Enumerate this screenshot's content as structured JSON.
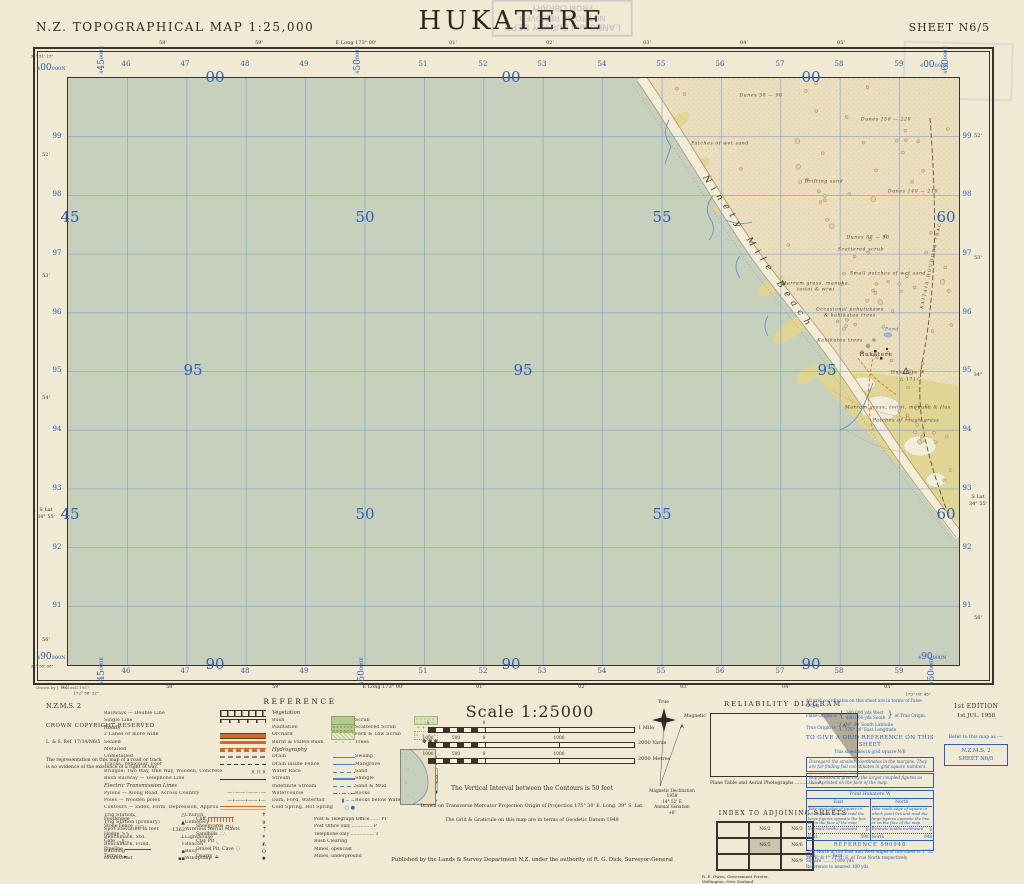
{
  "header": {
    "left": "N.Z. TOPOGRAPHICAL MAP  1:25,000",
    "title": "HUKATERE",
    "right": "SHEET N6/5"
  },
  "stamp": {
    "line1": "LANDS and SURVEY DEPT.",
    "line2": "NOT TO BE REMOVED",
    "line3": "FROM LIBRARY"
  },
  "colors": {
    "paper": "#f0e9d3",
    "sea": "#c6d0bd",
    "sand": "#ecdfc0",
    "beach": "#f3ecd8",
    "grass": "#e0d592",
    "grid_blue": "#7fa3cf",
    "number_blue": "#2d5eb0",
    "road_orange": "#cf6b2e",
    "stream_blue": "#5f8dc4",
    "border_ink": "#39332a"
  },
  "map": {
    "drawn_note": "Drawn by J. Maxwell 1957",
    "beach_name": "Ninety Mile Beach",
    "track_name": "KAITAIA  HOUHORA  TRACK",
    "grid": {
      "eastings": [
        {
          "x": 124,
          "t": "46"
        },
        {
          "x": 183,
          "t": "47"
        },
        {
          "x": 243,
          "t": "48"
        },
        {
          "x": 302,
          "t": "49"
        },
        {
          "x": 421,
          "t": "51"
        },
        {
          "x": 481,
          "t": "52"
        },
        {
          "x": 540,
          "t": "53"
        },
        {
          "x": 600,
          "t": "54"
        },
        {
          "x": 659,
          "t": "55"
        },
        {
          "x": 718,
          "t": "56"
        },
        {
          "x": 778,
          "t": "57"
        },
        {
          "x": 837,
          "t": "58"
        },
        {
          "x": 897,
          "t": "59"
        }
      ],
      "northings": [
        {
          "y": 134,
          "t": "99"
        },
        {
          "y": 192,
          "t": "98"
        },
        {
          "y": 251,
          "t": "97"
        },
        {
          "y": 310,
          "t": "96"
        },
        {
          "y": 368,
          "t": "95"
        },
        {
          "y": 427,
          "t": "94"
        },
        {
          "y": 486,
          "t": "93"
        },
        {
          "y": 545,
          "t": "92"
        },
        {
          "y": 603,
          "t": "91"
        }
      ],
      "big": [
        {
          "x": 147,
          "y": 0,
          "t": "00"
        },
        {
          "x": 443,
          "y": 0,
          "t": "00"
        },
        {
          "x": 743,
          "y": 0,
          "t": "00"
        },
        {
          "x": 2,
          "y": 140,
          "t": "45"
        },
        {
          "x": 297,
          "y": 140,
          "t": "50"
        },
        {
          "x": 594,
          "y": 140,
          "t": "55"
        },
        {
          "x": 878,
          "y": 140,
          "t": "60"
        },
        {
          "x": 125,
          "y": 293,
          "t": "95"
        },
        {
          "x": 455,
          "y": 293,
          "t": "95"
        },
        {
          "x": 759,
          "y": 293,
          "t": "95"
        },
        {
          "x": 2,
          "y": 437,
          "t": "45"
        },
        {
          "x": 297,
          "y": 437,
          "t": "50"
        },
        {
          "x": 594,
          "y": 437,
          "t": "55"
        },
        {
          "x": 878,
          "y": 437,
          "t": "60"
        },
        {
          "x": 147,
          "y": 587,
          "t": "90"
        },
        {
          "x": 443,
          "y": 587,
          "t": "90"
        },
        {
          "x": 743,
          "y": 587,
          "t": "90"
        }
      ],
      "corner_n": [
        {
          "x": 37,
          "y": 64,
          "a": "4",
          "b": "00",
          "c": "000N"
        },
        {
          "x": 920,
          "y": 61,
          "a": "4",
          "b": "00",
          "c": "000N"
        },
        {
          "x": 37,
          "y": 653,
          "a": "4",
          "b": "90",
          "c": "000N"
        },
        {
          "x": 918,
          "y": 653,
          "a": "4",
          "b": "90",
          "c": "000N"
        }
      ],
      "vertical_e": [
        {
          "x": 98,
          "y": 46,
          "a": "4",
          "b": "45",
          "c": "000E"
        },
        {
          "x": 98,
          "y": 657,
          "a": "4",
          "b": "45",
          "c": "000E"
        },
        {
          "x": 354,
          "y": 46,
          "a": "4",
          "b": "50",
          "c": "000E"
        },
        {
          "x": 358,
          "y": 657,
          "a": "4",
          "b": "50",
          "c": "000E"
        },
        {
          "x": 942,
          "y": 46,
          "a": "4",
          "b": "60",
          "c": "000E"
        },
        {
          "x": 928,
          "y": 657,
          "a": "4",
          "b": "60",
          "c": "000E"
        }
      ],
      "lats_left": [
        {
          "y": 155,
          "t": "52'"
        },
        {
          "y": 276,
          "t": "53'"
        },
        {
          "y": 398,
          "t": "54'"
        },
        {
          "y": 510,
          "t": "S Lat"
        },
        {
          "y": 517,
          "t": "34° 55'"
        },
        {
          "y": 640,
          "t": "56'"
        }
      ],
      "lats_right": [
        {
          "y": 136,
          "t": "52'"
        },
        {
          "y": 258,
          "t": "53'"
        },
        {
          "y": 375,
          "t": "34°"
        },
        {
          "y": 497,
          "t": "S Lat"
        },
        {
          "y": 504,
          "t": "34° 55'"
        },
        {
          "y": 618,
          "t": "56'"
        }
      ],
      "lons_top": [
        {
          "x": 163,
          "t": "58'"
        },
        {
          "x": 259,
          "t": "59'"
        },
        {
          "x": 356,
          "t": "E Long 173° 00'"
        },
        {
          "x": 453,
          "t": "01'"
        },
        {
          "x": 550,
          "t": "02'"
        },
        {
          "x": 647,
          "t": "03'"
        },
        {
          "x": 744,
          "t": "04'"
        },
        {
          "x": 841,
          "t": "05'"
        }
      ],
      "lons_bottom": [
        {
          "x": 65,
          "t": "57'"
        },
        {
          "x": 170,
          "t": "58'"
        },
        {
          "x": 276,
          "t": "59'"
        },
        {
          "x": 383,
          "t": "E Long 173° 00'"
        },
        {
          "x": 480,
          "t": "01'"
        },
        {
          "x": 582,
          "t": "02'"
        },
        {
          "x": 684,
          "t": "03'"
        },
        {
          "x": 786,
          "t": "04'"
        },
        {
          "x": 888,
          "t": "05'"
        }
      ],
      "corner_grat": [
        {
          "x": 42,
          "y": 56,
          "t": "34° 51' 15\""
        },
        {
          "x": 42,
          "y": 666,
          "t": "34° 56' 08\""
        },
        {
          "x": 86,
          "y": 693,
          "t": "172° 58' 32\""
        },
        {
          "x": 918,
          "y": 694,
          "t": "173° 05' 45\""
        }
      ]
    },
    "land_labels": [
      {
        "x": 693,
        "y": 18,
        "t": "Dunes   50 — 90",
        "c": "dune"
      },
      {
        "x": 818,
        "y": 42,
        "t": "Dunes   150 — 220",
        "c": "dune"
      },
      {
        "x": 652,
        "y": 66,
        "t": "Patches of wet sand",
        "c": "dune"
      },
      {
        "x": 756,
        "y": 104,
        "t": "Drifting      sand",
        "c": "dune"
      },
      {
        "x": 845,
        "y": 114,
        "t": "Dunes   140 — 210",
        "c": "dune"
      },
      {
        "x": 800,
        "y": 160,
        "t": "Dunes   80 — 90",
        "c": "dune"
      },
      {
        "x": 793,
        "y": 172,
        "t": "Scattered scrub",
        "c": "dune"
      },
      {
        "x": 820,
        "y": 196,
        "t": "Small patches of wet sand",
        "c": "dune"
      },
      {
        "x": 748,
        "y": 206,
        "t": "Marram grass, manuka,",
        "c": "dune"
      },
      {
        "x": 748,
        "y": 212,
        "t": "toitoi & wiwi",
        "c": "dune"
      },
      {
        "x": 782,
        "y": 232,
        "t": "Occasional pohutukawa",
        "c": "dune"
      },
      {
        "x": 782,
        "y": 238,
        "t": "& kahikatea trees",
        "c": "dune"
      },
      {
        "x": 772,
        "y": 263,
        "t": "Kahikatea trees",
        "c": "dune"
      },
      {
        "x": 824,
        "y": 252,
        "t": "Pond",
        "c": "blue"
      },
      {
        "x": 808,
        "y": 277,
        "t": "Hukatere",
        "c": "place"
      },
      {
        "x": 840,
        "y": 295,
        "t": "Hukatere W",
        "c": "trig"
      },
      {
        "x": 840,
        "y": 302,
        "t": "△ 171",
        "c": "trig"
      },
      {
        "x": 830,
        "y": 330,
        "t": "Marram grass, toitoi, manuka & flax",
        "c": "dune"
      },
      {
        "x": 838,
        "y": 343,
        "t": "Patches of rough grass",
        "c": "dune"
      }
    ]
  },
  "copyright": {
    "series": "N.Z.M.S. 2",
    "crown": "CROWN COPYRIGHT RESERVED",
    "ref": "L. & S. Ref. 17/34/N6/5",
    "para": "The representation on this map of a road or track is no evidence of the existence of a right of way."
  },
  "legend": {
    "title": "REFERENCE",
    "col1": [
      {
        "t": "Railways — Double Line",
        "s": "rail2"
      },
      {
        "t": "Single Line",
        "s": "rail1"
      },
      {
        "h": "Roads"
      },
      {
        "t": "2 Lanes or more wide",
        "s": "roadw"
      },
      {
        "t": "Sealed",
        "s": "roads"
      },
      {
        "t": "Metalled",
        "s": "roadm"
      },
      {
        "t": "Unmetalled",
        "s": "roadu"
      },
      {
        "t": "Tracks, Vehicular, Foot",
        "s": "trackd"
      },
      {
        "t": "Bridges: Two Way, One Way, Wooden, Concrete",
        "s": "g:)(  )(  )("
      },
      {
        "t": "Bush Railway — Telephone Line",
        "s": "tel"
      },
      {
        "h": "Electric Transmission Lines"
      },
      {
        "t": "Pylons — Along Road, Across Country",
        "s": "g:—◦——◦——◦—"
      },
      {
        "t": "Poles — Wooden poles",
        "s": "g:—•——•——•—"
      },
      {
        "t": "Contours — Index, Form, Depression, Approx.",
        "s": "cont"
      },
      {
        "a": [
          "Trig Station",
          "g:△"
        ],
        "b": [
          "Church",
          "g:✝"
        ]
      },
      {
        "a": [
          "Trig Station (primary)",
          "g:▲"
        ],
        "b": [
          "Cemetery",
          "g:✞"
        ]
      },
      {
        "a": [
          "Spot Elevation in feet",
          "g:· 1362"
        ],
        "b": [
          "Wireless Aerial Masts",
          "g:⍑"
        ]
      },
      {
        "a": [
          "Benchmark, Std.",
          "g:⊥"
        ],
        "b": [
          "Lighthouse",
          "g:✶"
        ]
      },
      {
        "a": [
          "Benchmark, Fund.",
          "g:⊦"
        ],
        "b": [
          "Beacon",
          "g:◭"
        ]
      },
      {
        "a": [
          "Building",
          "g:▪"
        ],
        "b": [
          "Buoy",
          "g:ʘ"
        ]
      },
      {
        "a": [
          "Homestead",
          "g:▪▪"
        ],
        "b": [
          "Windpump",
          "g:✹"
        ]
      }
    ],
    "col2": [
      {
        "h": "Vegetation"
      },
      {
        "a": [
          "Bush",
          "vbush"
        ],
        "b": [
          "Scrub",
          "vscrub"
        ]
      },
      {
        "a": [
          "Plantation",
          "vplant"
        ],
        "b": [
          "Scattered Scrub",
          "vscat"
        ]
      },
      {
        "a": [
          "Orchard",
          "vorch"
        ],
        "b": [
          "Fern & Low Scrub",
          "vfern"
        ]
      },
      {
        "a": [
          "Burnt & Fallen Bush",
          "vburn"
        ],
        "b": [
          "Trees",
          "g:✽ ✽ ✽"
        ]
      },
      {
        "h": "Hydrography"
      },
      {
        "a": [
          "Drain",
          "hline"
        ],
        "b": [
          "Swamp",
          "gb:≈≈≈"
        ]
      },
      {
        "a": [
          "Drain inside Fence",
          "hline"
        ],
        "b": [
          "Mangrove",
          "gb:※※"
        ]
      },
      {
        "a": [
          "Water Race",
          "hdash"
        ],
        "b": [
          "Sand",
          "hsand"
        ]
      },
      {
        "a": [
          "Stream",
          "hline2"
        ],
        "b": [
          "Shingle",
          "hshin"
        ]
      },
      {
        "a": [
          "Indefinite Stream",
          "hdash"
        ],
        "b": [
          "Sand & Mud",
          "hmud"
        ]
      },
      {
        "a": [
          "Watercourse",
          "hdd"
        ],
        "b": [
          "Rocks",
          "g:✱"
        ]
      },
      {
        "a": [
          "Dam, Ford, Waterfall",
          "gb:▮ ⌣ ~"
        ],
        "b": [
          "Rocks below Water",
          "gb:∗"
        ]
      },
      {
        "a": [
          "Cold Spring, Hot Spring",
          "gb:○ ●"
        ],
        "b": [
          "",
          ""
        ]
      }
    ],
    "bottom": [
      [
        "Footbridge",
        "g:⌒",
        "Cliff",
        "cliff",
        "Post & Telegraph Office ...... PT"
      ],
      [
        "Stone Fence",
        "g:▭▭",
        "Sheepyards",
        "g:⊓⊔",
        "Post Office only .............. P"
      ],
      [
        "Hedge",
        "g:∿∿",
        "Sandhills",
        "g:∴∴",
        "Telephone only ................ T"
      ],
      [
        "Gate",
        "g:—∥—",
        "Clay Pit",
        "g:◟",
        "Bush Clearing"
      ],
      [
        "Pipeline",
        "pipe",
        "Gravel Pit, Cave",
        "g:◌",
        "Mines, opencast"
      ],
      [
        "Terrace",
        "g:⫢",
        "Quarry",
        "g:⟁",
        "Mines, underground"
      ]
    ]
  },
  "scaleblock": {
    "title": "Scale 1:25000",
    "mile": {
      "labels": [
        {
          "p": 0,
          "t": "1"
        },
        {
          "p": 56,
          "t": "0"
        }
      ],
      "right": "1 Mile"
    },
    "yards": {
      "labels": [
        {
          "p": 0,
          "t": "1000"
        },
        {
          "p": 28,
          "t": "500"
        },
        {
          "p": 56,
          "t": "0"
        },
        {
          "p": 131,
          "t": "1000"
        }
      ],
      "right": "2000 Yards"
    },
    "metres": {
      "labels": [
        {
          "p": 0,
          "t": "1000"
        },
        {
          "p": 28,
          "t": "500"
        },
        {
          "p": 56,
          "t": "0"
        },
        {
          "p": 131,
          "t": "1000"
        }
      ],
      "right": "2000 Metres"
    },
    "vi": "The Vertical Interval between the Contours is 50 feet",
    "proj": "Drawn on Transverse Mercator Projection      Origin of Projection 175° 30' E. Long.   39° S. Lat.",
    "datum": "The Grid & Graticule on this map are in terms of Geodetic Datum 1949",
    "publisher": "Published by the Lands & Survey Department N.Z. under the authority of R. G. Dick, Surveyor-General"
  },
  "compass": {
    "true_label": "True",
    "magnetic_label": "Magnetic",
    "caption": [
      "Magnetic Declination",
      "1958",
      "14° 52' E",
      "Annual Variation",
      "+8'"
    ]
  },
  "reliability": {
    "title": "RELIABILITY DIAGRAM",
    "zone": "A",
    "caption": "Plane Table and Aerial Photographs ............... A"
  },
  "adjoining": {
    "title": "INDEX TO ADJOINING SHEETS",
    "cells": [
      [
        "",
        "N6/2",
        "N6/3"
      ],
      [
        "",
        "N6/5",
        "N6/6"
      ],
      [
        "",
        "",
        "N6/9"
      ]
    ],
    "self": "N6/5",
    "printer": [
      "R. E. Owen, Government Printer,",
      "Wellington, New Zealand"
    ]
  },
  "gridref": {
    "l1": "All grid coordinates on this sheet are in terms of False Origin.",
    "l2a": "False Origin is",
    "l2b": "300,000 yds West",
    "l2c": "400,000 yds South",
    "l2d": "of True Origin.",
    "l3a": "True Origin is",
    "l3b": "39° 00' South Latitude",
    "l3c": "175° 30' East Longitude",
    "title": "TO GIVE A GRID REFERENCE ON THIS SHEET",
    "sub": "This sheet lies in grid square N/B",
    "note1": "Disregard the smaller coordinates in the margins. They are for finding full coordinates in grid square numbers.",
    "note2": "Any position is given by the larger coupled figures as those printed on the face of the map.",
    "point_label": "Point   Hukatere W",
    "east_head": "East",
    "east_inst": "Take west edge of square in which point lies and read the large figures opposite the line or on the face of the map",
    "east_val": "59",
    "east_tenths": "Estimate tenths eastward",
    "east_tenths_val": "0",
    "east_total_label": "East",
    "east_total": "590",
    "north_head": "North",
    "north_inst": "Take south edge of square in which point lies and read the large figures opposite the line or on the face of the map",
    "north_val": "94",
    "north_tenths": "Estimate tenths northward",
    "north_tenths_val": "8",
    "north_total_label": "North",
    "north_total": "948",
    "refline": "REFERENCE   590948",
    "units": [
      "Unit ........... Yard",
      "Square ........ 1000 yds",
      "Reference to nearest 100 yds"
    ],
    "gnote": "Grid North at the East and West edges of this sheet is 1° 32' 26\" E. & 1° 27' 0\" E. of True North respectively."
  },
  "edition": {
    "e1": "1st EDITION",
    "e2": "1st JUL. 1958",
    "refer": "Refer to this map as :—",
    "box1": "N.Z.M.S. 2",
    "box2": "SHEET N6/5"
  }
}
